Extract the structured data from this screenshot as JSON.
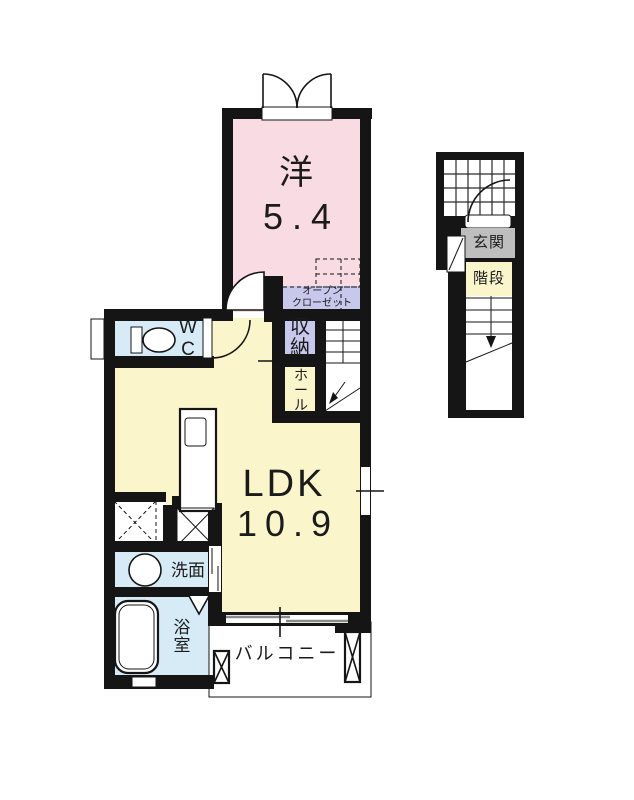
{
  "floorplan": {
    "rooms": {
      "western": {
        "label": "洋",
        "size": "5.4"
      },
      "ldk": {
        "label": "LDK",
        "size": "10.9"
      },
      "wc": {
        "label": "W\nC"
      },
      "storage": {
        "label": "収納"
      },
      "hall": {
        "label": "ホール"
      },
      "open_closet": {
        "label": "オープン\nクローゼット"
      },
      "washroom": {
        "label": "洗面"
      },
      "bathroom": {
        "label": "浴室"
      },
      "balcony": {
        "label": "バルコニー"
      },
      "entrance": {
        "label": "玄関"
      },
      "stairs": {
        "label": "階段"
      }
    },
    "colors": {
      "wall": "#151515",
      "western_room": "#f9dbe4",
      "ldk": "#fbf5cc",
      "wet_area": "#d6ebf6",
      "closet": "#c8c8ec",
      "entrance_gray": "#bebebe"
    }
  }
}
